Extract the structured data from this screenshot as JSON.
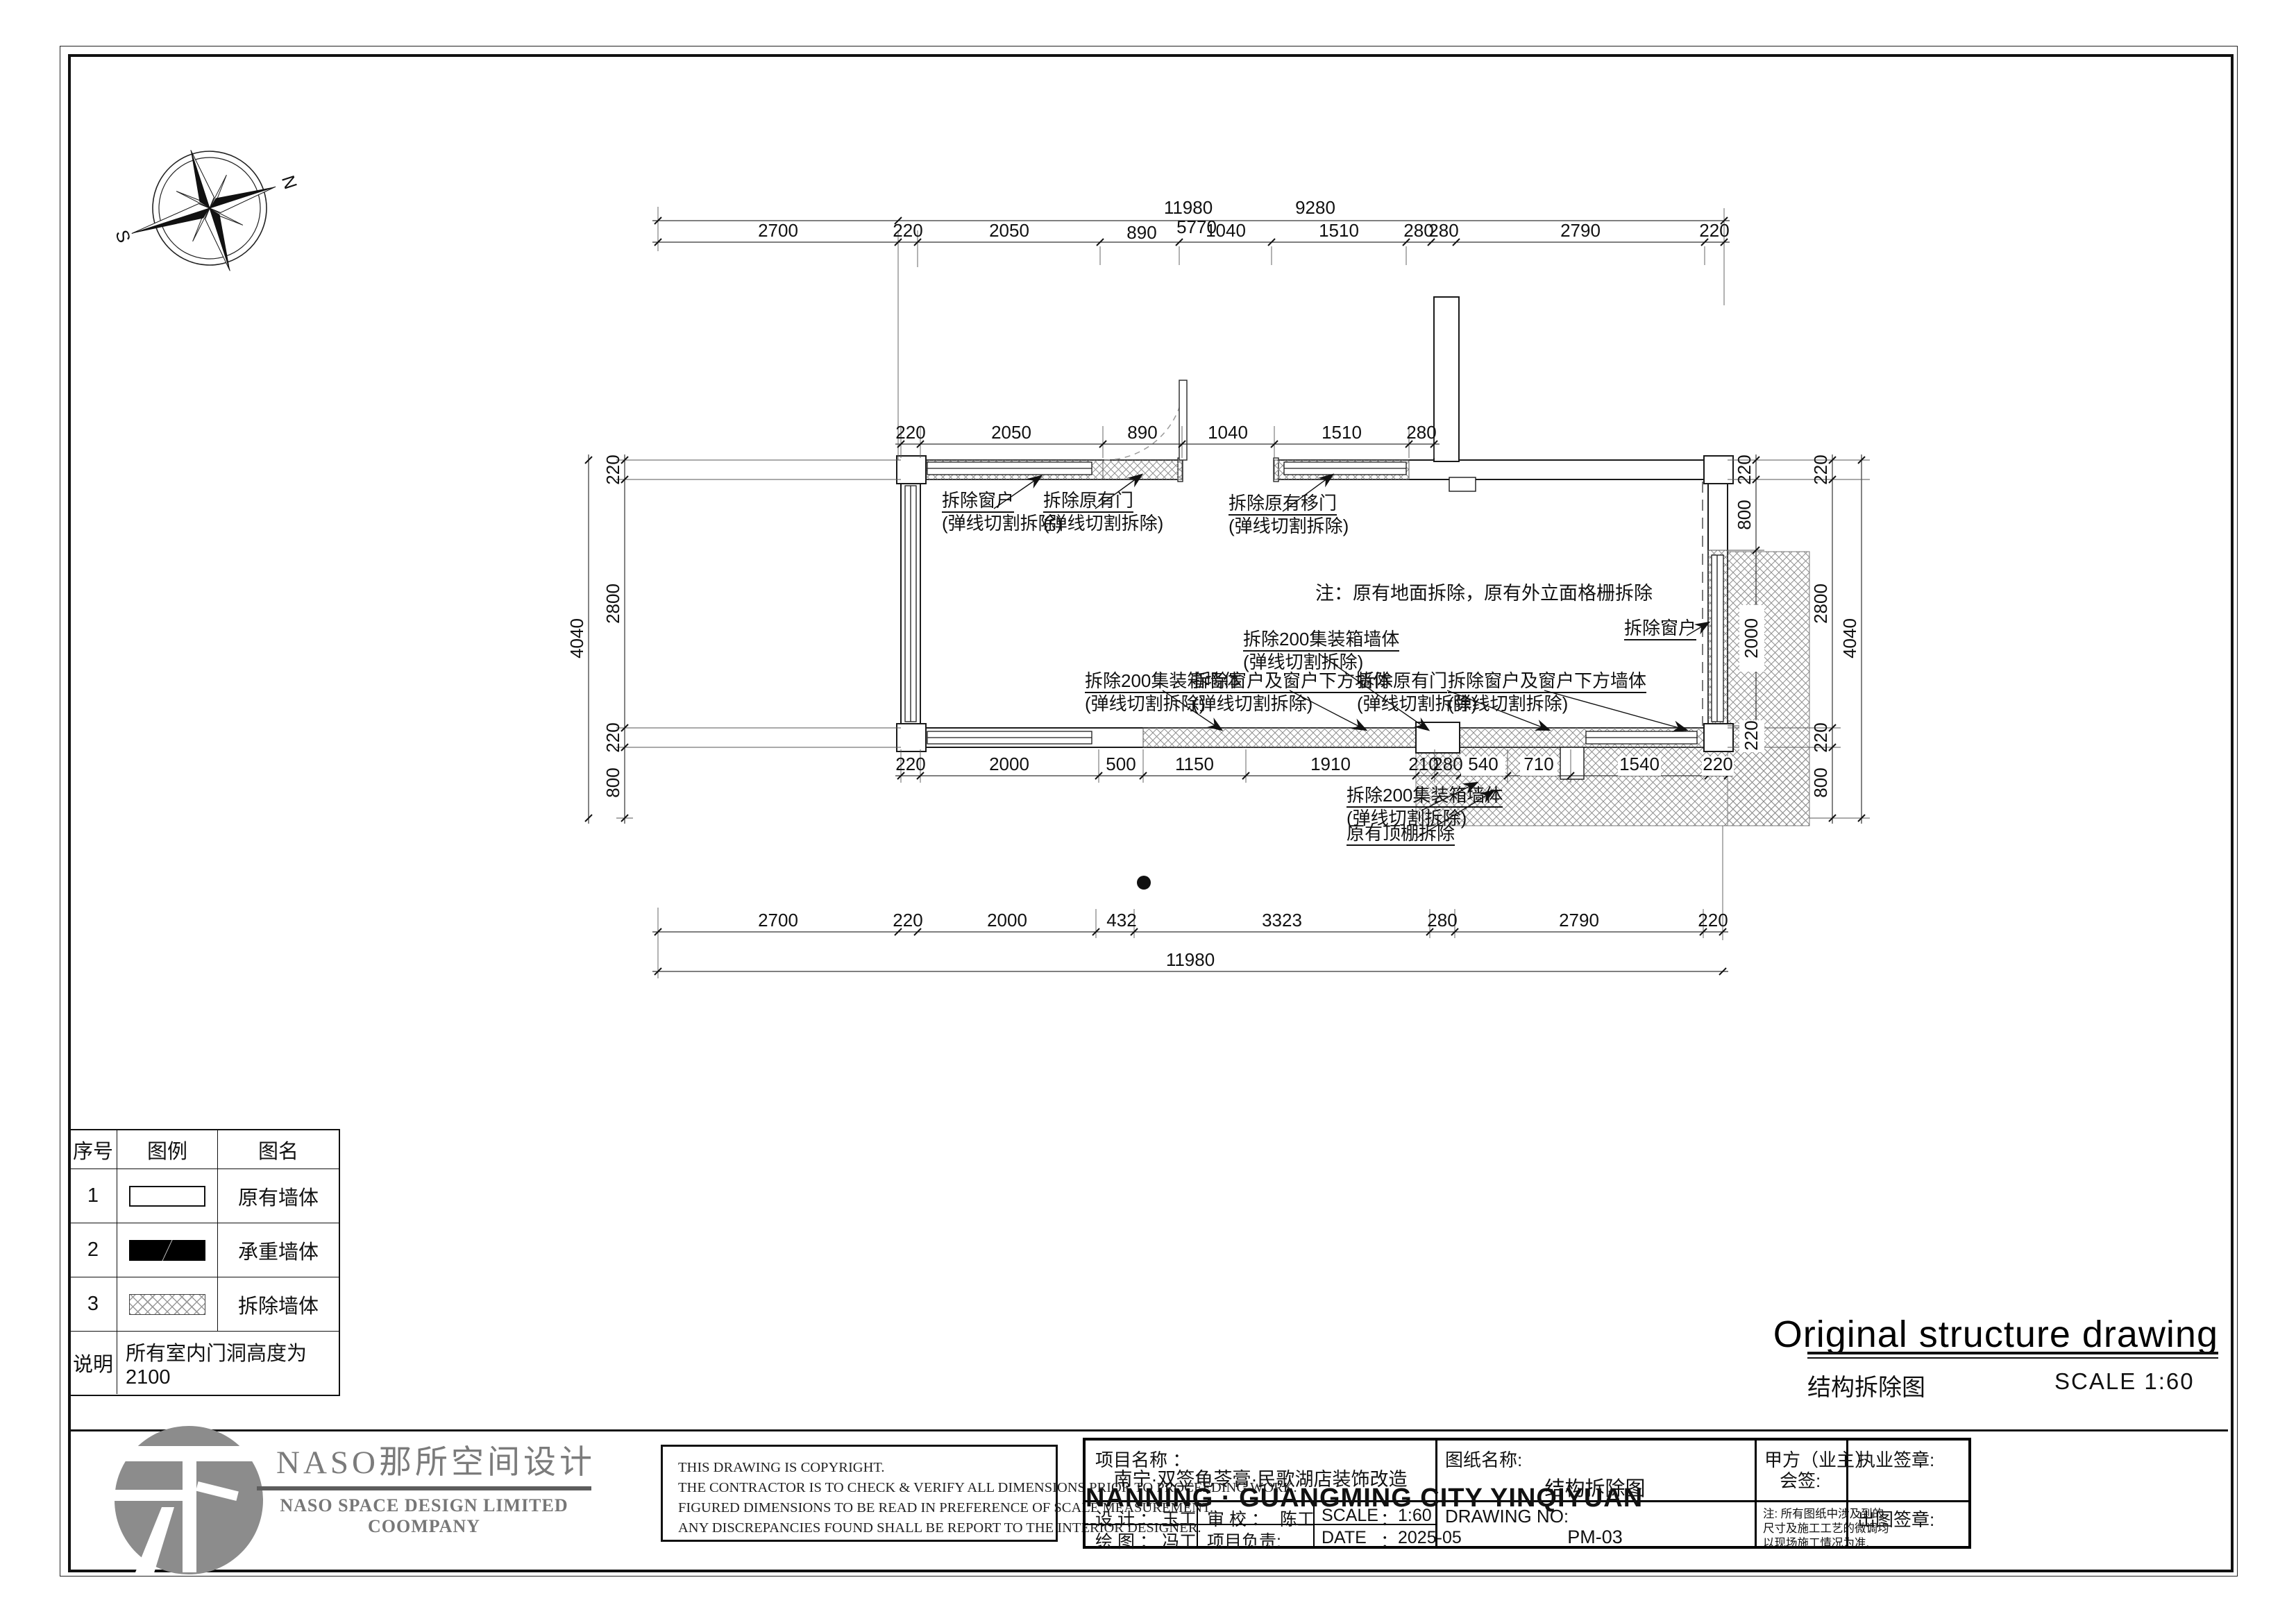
{
  "compass": {
    "north": "N",
    "south": "S"
  },
  "plan": {
    "note": "注：原有地面拆除，原有外立面格栅拆除",
    "callouts": [
      {
        "text": "拆除窗户",
        "sub": "(弹线切割拆除)"
      },
      {
        "text": "拆除原有门",
        "sub": "(弹线切割拆除)"
      },
      {
        "text": "拆除原有移门",
        "sub": "(弹线切割拆除)"
      },
      {
        "text": "拆除200集装箱墙体",
        "sub": "(弹线切割拆除)"
      },
      {
        "text": "拆除200集装箱墙体",
        "sub": "(弹线切割拆除)"
      },
      {
        "text": "拆除窗户及窗户下方墙体",
        "sub": "(弹线切割拆除)"
      },
      {
        "text": "拆除原有门",
        "sub": "(弹线切割拆除)"
      },
      {
        "text": "拆除窗户及窗户下方墙体",
        "sub": "(弹线切割拆除)"
      },
      {
        "text": "拆除窗户",
        "sub": ""
      },
      {
        "text": "拆除200集装箱墙体",
        "sub": "(弹线切割拆除)"
      },
      {
        "text": "原有顶棚拆除",
        "sub": ""
      }
    ],
    "dims": {
      "top1": [
        "11980",
        "9280"
      ],
      "top2": [
        "2700",
        "220",
        "2050",
        "890",
        "1040",
        "1510",
        "280",
        "280",
        "2790",
        "220"
      ],
      "top2b": "5770",
      "top3": [
        "220",
        "2050",
        "890",
        "1040",
        "1510",
        "280"
      ],
      "bot1": [
        "220",
        "2000",
        "500",
        "1150",
        "1910",
        "210",
        "280",
        "540",
        "710",
        "1540",
        "220"
      ],
      "bot2": [
        "2700",
        "220",
        "2000",
        "432",
        "3323",
        "280",
        "2790",
        "220"
      ],
      "bot3": "11980",
      "left1": [
        "220",
        "2800",
        "220",
        "800"
      ],
      "left2": "4040",
      "rightA": [
        "220",
        "800",
        "2000",
        "220"
      ],
      "rightB": [
        "220",
        "2800",
        "220",
        "800"
      ],
      "rightC": "4040"
    }
  },
  "legend": {
    "headers": [
      "序号",
      "图例",
      "图名"
    ],
    "rows": [
      {
        "no": "1",
        "name": "原有墙体"
      },
      {
        "no": "2",
        "name": "承重墙体"
      },
      {
        "no": "3",
        "name": "拆除墙体"
      }
    ],
    "note_label": "说明",
    "note_value": "所有室内门洞高度为2100"
  },
  "title": {
    "en": "Original structure drawing",
    "zh": "结构拆除图",
    "scale": "SCALE   1:60"
  },
  "titlebar": {
    "logo_zh": "NASO那所空间设计",
    "logo_en": "NASO  SPACE  DESIGN  LIMITED  COOMPANY",
    "copyright": [
      "THIS DRAWING IS COPYRIGHT.",
      "THE CONTRACTOR IS TO CHECK & VERIFY ALL DIMENSIONS PRIOR TO PROCEEDING WORK.",
      "FIGURED DIMENSIONS TO BE READ IN PREFERENCE OF SCALE MEASUREMENT.",
      "ANY DISCREPANCIES FOUND SHALL BE REPORT TO THE INTERIOR DESIGNER."
    ],
    "project_label": "项目名称    ：",
    "project_zh": "南宁·双签龟苓膏·民歌湖店装饰改造",
    "project_en": "NANNING · GUANGMING CITY YINQIYUAN",
    "design_label": "设  计  ：",
    "design_value": "玉工",
    "check_label": "审  校  ：",
    "check_value": "陈工",
    "scale_label": "SCALE",
    "scale_colon": "：",
    "scale_value": "1:60",
    "draw_label": "绘  图  ：",
    "draw_value": "冯工",
    "pm_label": "项目负责:",
    "date_label": "DATE",
    "date_colon": "：",
    "date_value": "2025-05",
    "sheetname_label": "图纸名称:",
    "sheetname_value": "结构拆除图",
    "drawingno_label": "DRAWING NO:",
    "drawingno_value": "PM-03",
    "owner_label": "甲方（业主）",
    "owner_sub": "会签:",
    "owner_note1": "注: 所有图纸中涉及到的",
    "owner_note2": "尺寸及施工工艺的微调均",
    "owner_note3": "以现场施工情况为准.",
    "seal1_label": "执业签章:",
    "seal2_label": "出图签章:"
  }
}
